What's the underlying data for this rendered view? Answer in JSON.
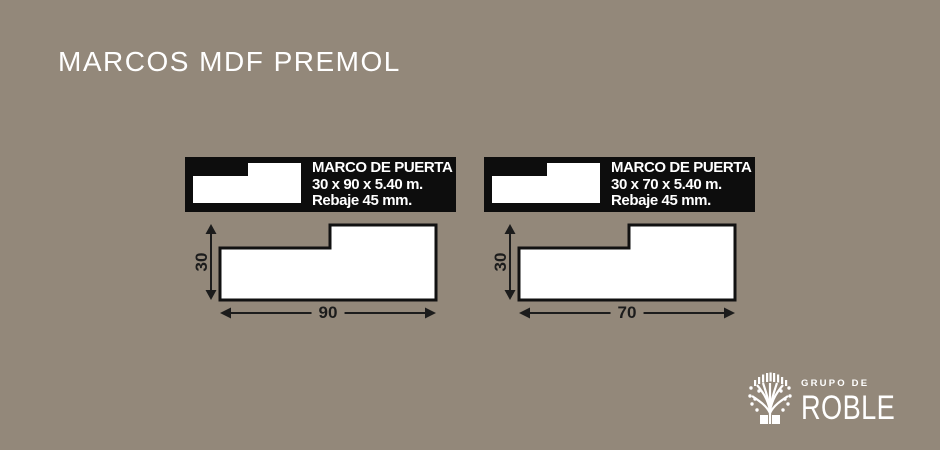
{
  "title": "MARCOS MDF PREMOL",
  "colors": {
    "background": "#93887a",
    "panel": "#0d0d0d",
    "ink": "#1c1c1c",
    "light": "#ffffff"
  },
  "diagrams": [
    {
      "label_title": "MARCO DE PUERTA",
      "label_size": "30 x 90 x 5.40 m.",
      "label_rebate": "Rebaje 45 mm.",
      "height_mm": "30",
      "width_mm": "90"
    },
    {
      "label_title": "MARCO DE PUERTA",
      "label_size": "30 x 70 x 5.40 m.",
      "label_rebate": "Rebaje 45 mm.",
      "height_mm": "30",
      "width_mm": "70"
    }
  ],
  "logo": {
    "group": "GRUPO DE",
    "brand": "ROBLE"
  }
}
